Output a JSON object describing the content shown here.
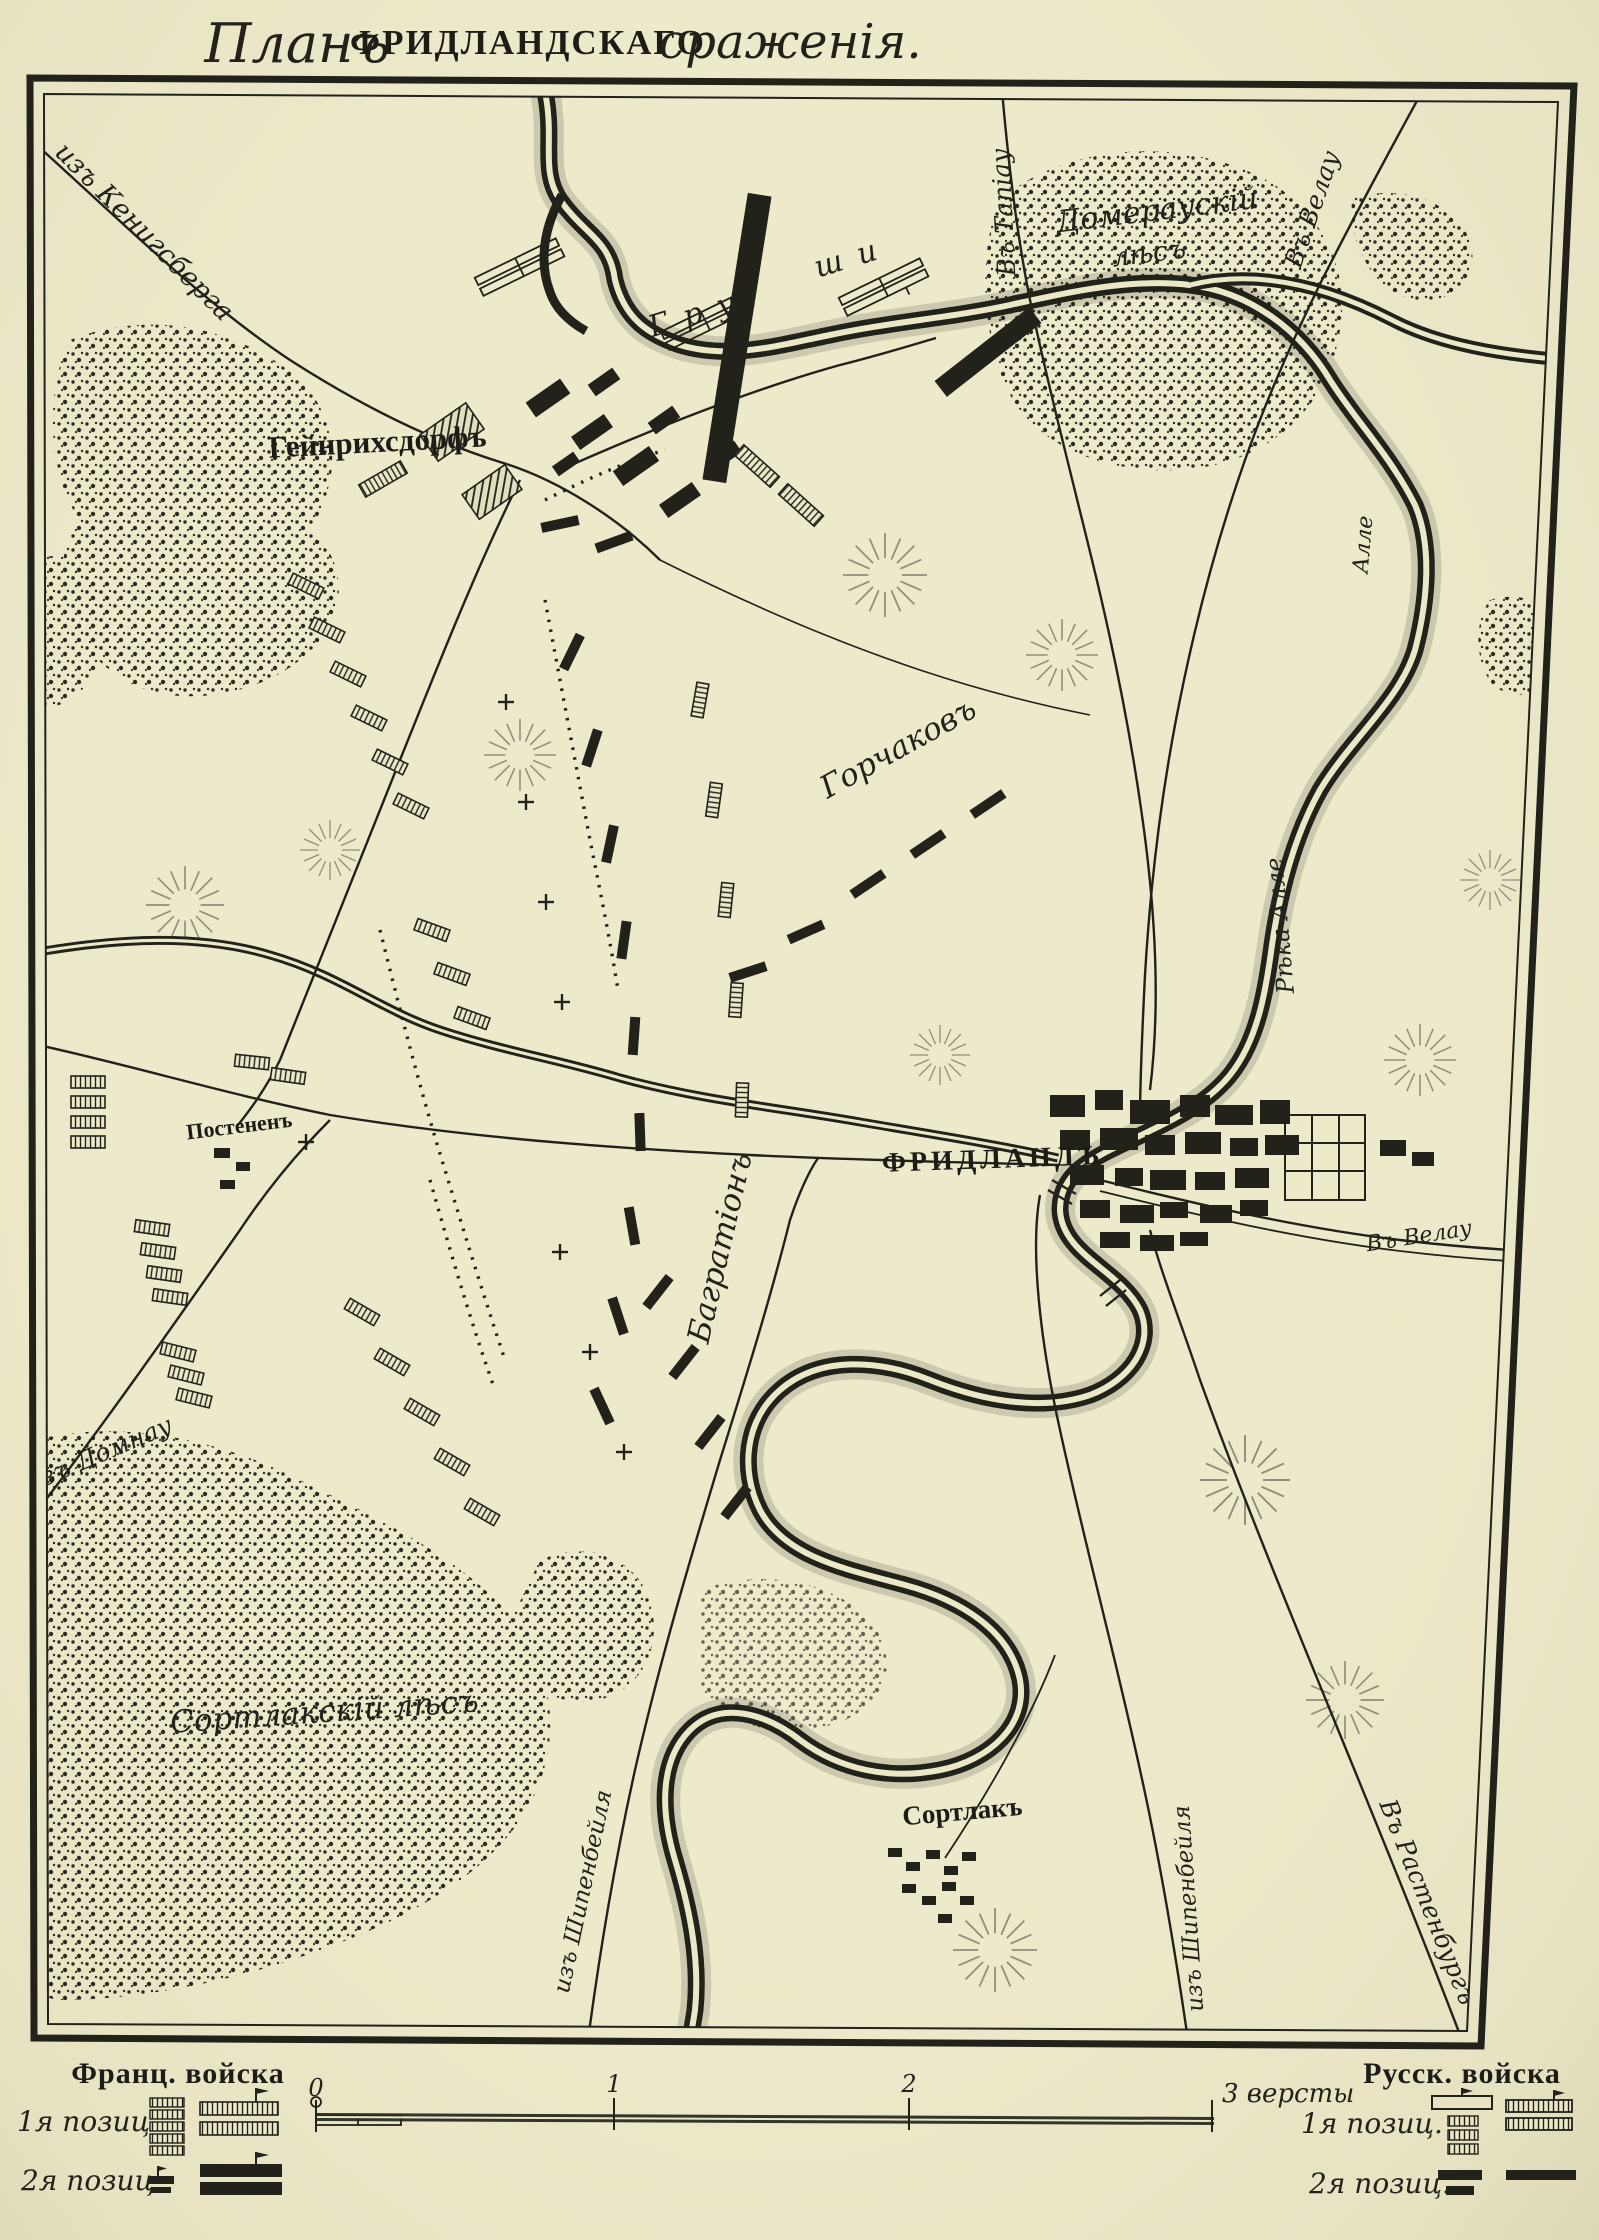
{
  "title": {
    "script_prefix": "Планъ",
    "main": "ФРИДЛАНДСКАГО",
    "script_suffix": "сраженія."
  },
  "map": {
    "labels": {
      "from_koenigsberg": "изъ Кенигсберга",
      "heinrichsdorf": "Гейнрихсдорфъ",
      "grouchy_a": "Гру",
      "grouchy_b": "ши",
      "domerau_forest_1": "Домераускій",
      "domerau_forest_2": "лѣсъ",
      "to_tapiau": "Въ Тапіау",
      "to_wehlau_top": "Въ Велау",
      "gorchakov": "Горчаковъ",
      "friedland": "ФРИДЛАНДЪ",
      "alle_upper": "Алле",
      "alle_river": "Рѣка Алле",
      "to_wehlau_right": "Въ Велау",
      "bagration": "Багратіонъ",
      "posthenen": "Постененъ",
      "from_domnau": "изъ Домнау",
      "sortlack_forest": "Сортлакскій лѣсъ",
      "sortlack": "Сортлакъ",
      "from_schippenbeil_left": "изъ Шипенбейля",
      "from_schippenbeil_right": "изъ Шипенбейля",
      "to_rastenburg": "Въ Растенбургъ"
    }
  },
  "legend": {
    "french": {
      "title": "Франц. войска",
      "pos1": "1я позиц.",
      "pos2": "2я позиц."
    },
    "russian": {
      "title": "Русск. войска",
      "pos1": "1я позиц.",
      "pos2": "2я позиц."
    },
    "scale": {
      "t0": "0",
      "t1": "1",
      "t2": "2",
      "end": "3 версты"
    }
  },
  "colors": {
    "paper": "#ebe8c8",
    "ink": "#201f18"
  }
}
